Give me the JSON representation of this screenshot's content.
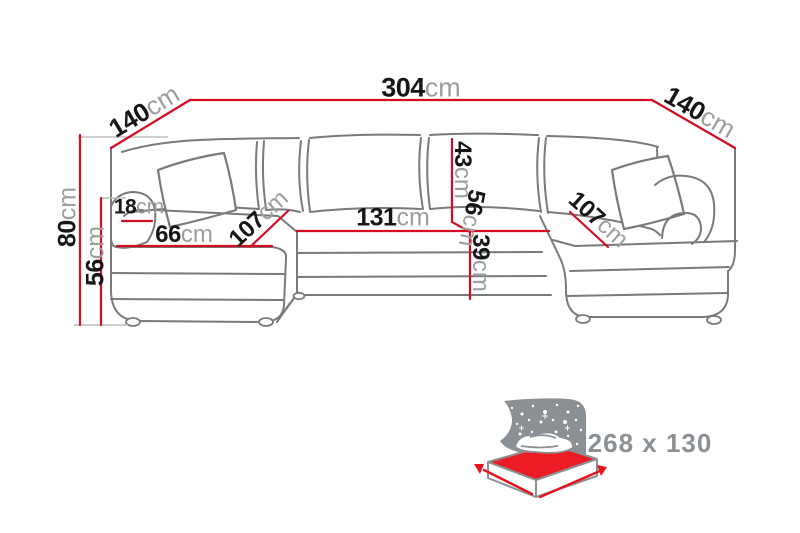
{
  "diagram": {
    "title_semantic": "u-shaped-sectional-sofa-dimension-diagram",
    "units": "cm",
    "dims": {
      "top_width": {
        "value": "304",
        "unit": "cm"
      },
      "left_depth": {
        "value": "140",
        "unit": "cm"
      },
      "right_depth": {
        "value": "140",
        "unit": "cm"
      },
      "total_height": {
        "value": "80",
        "unit": "cm"
      },
      "seat_height": {
        "value": "56",
        "unit": "cm"
      },
      "armrest_width": {
        "value": "18",
        "unit": "cm"
      },
      "left_seat_width": {
        "value": "66",
        "unit": "cm"
      },
      "left_seat_depth": {
        "value": "107",
        "unit": "cm"
      },
      "center_width": {
        "value": "131",
        "unit": "cm"
      },
      "backrest_height": {
        "value": "43",
        "unit": "cm"
      },
      "center_depth": {
        "value": "56",
        "unit": "cm"
      },
      "seat_front_height": {
        "value": "39",
        "unit": "cm"
      },
      "right_seat_depth": {
        "value": "107",
        "unit": "cm"
      }
    },
    "bed_function": {
      "icon": "sofa-bed-sleeping-area-icon",
      "label": "268 x 130"
    },
    "colors": {
      "dimension_line": "#d40e22",
      "label_number": "#161616",
      "label_unit": "#9d9d9d",
      "sofa_line": "#7a7a7a",
      "icon_gray": "#8b9095",
      "mattress_red": "#ec1c24",
      "background": "#ffffff"
    }
  }
}
